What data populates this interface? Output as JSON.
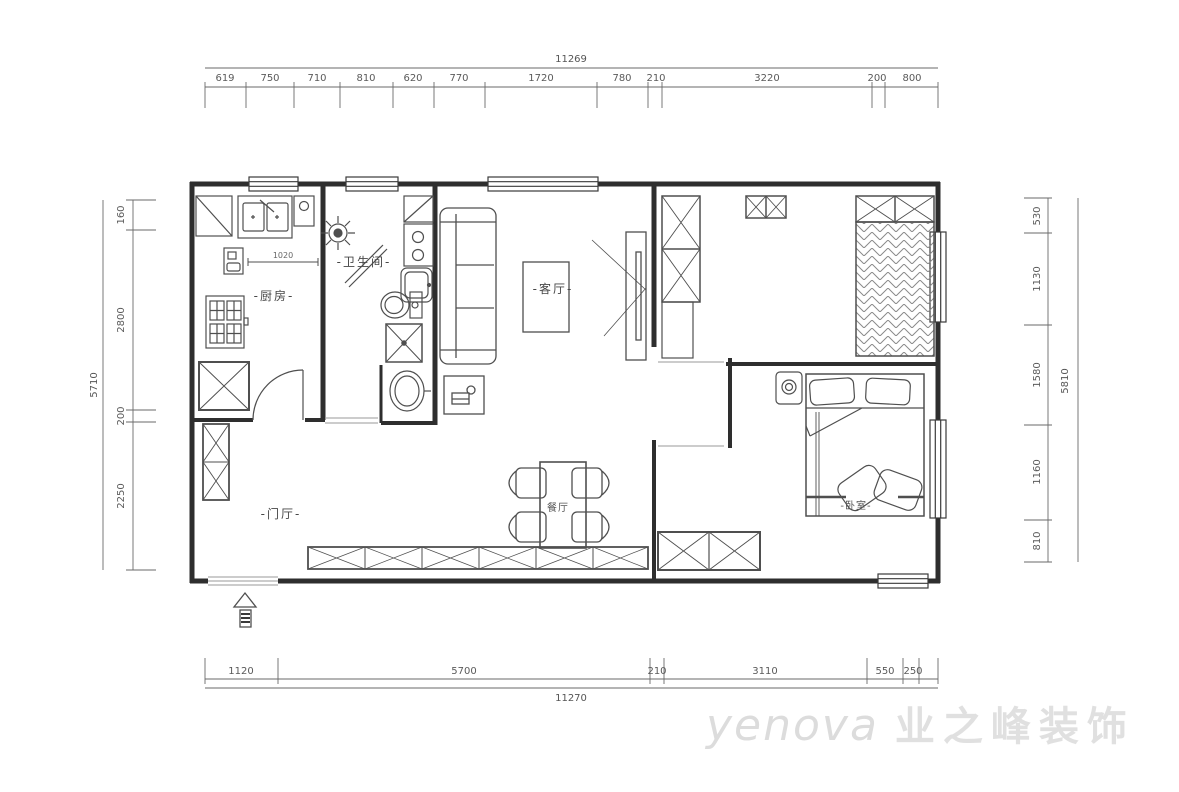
{
  "rooms": {
    "kitchen": {
      "label": "-厨房-"
    },
    "bathroom": {
      "label": "-卫生间-"
    },
    "living": {
      "label": "-客厅-"
    },
    "dining": {
      "label": "餐厅"
    },
    "hall": {
      "label": "-门厅-"
    },
    "bedroom": {
      "label": "-卧室-"
    }
  },
  "annotations": {
    "kitchen_counter": "1020"
  },
  "dimensions": {
    "top": {
      "total": "11269",
      "segments": [
        "619",
        "750",
        "710",
        "810",
        "620",
        "770",
        "1720",
        "780",
        "210",
        "3220",
        "200",
        "800"
      ]
    },
    "bottom": {
      "total": "11270",
      "segments": [
        "1120",
        "5700",
        "210",
        "3110",
        "550",
        "250"
      ]
    },
    "left": {
      "total": "5710",
      "segments": [
        "160",
        "2800",
        "200",
        "2250"
      ]
    },
    "right": {
      "total": "5810",
      "segments": [
        "530",
        "1130",
        "1580",
        "1160",
        "810"
      ]
    }
  },
  "watermark": {
    "brand": "yenova",
    "company": "业之峰装饰"
  },
  "colors": {
    "wall": "#2e2e2e",
    "furniture": "#4f4f4f",
    "dim": "#5a5a5a",
    "watermark": "#dcdcdc",
    "bg": "#ffffff"
  }
}
